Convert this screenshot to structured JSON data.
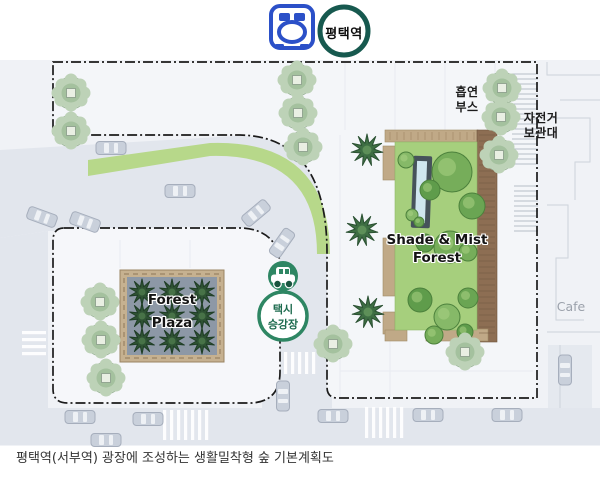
{
  "station": {
    "label": "평택역"
  },
  "taxi": {
    "line1": "택시",
    "line2": "승강장"
  },
  "labels": {
    "smoking_line1": "흡연",
    "smoking_line2": "부스",
    "bike_line1": "자전거",
    "bike_line2": "보관대",
    "cafe": "Cafe",
    "shade_mist_line1": "Shade & Mist",
    "shade_mist_line2": "Forest",
    "forest_plaza_line1": "Forest",
    "forest_plaza_line2": "Plaza"
  },
  "caption": "평택역(서부역) 광장에 조성하는 생활밀착형 숲 기본계획도",
  "colors": {
    "road": "#e2e6ed",
    "east_plaza": "#f4f6f9",
    "west_plaza": "#f6f7fa",
    "green_strip": "#b7d88a",
    "boundary": "#1b1b1b",
    "sage_outer": "#c7d8c2",
    "sage_mid": "#bdd2b7",
    "sage_inner": "#a4c19e",
    "spiky_fill": "#3e6e43",
    "spiky_edge": "#2b5133",
    "forest_ground": "#a6cf7d",
    "deck_tan": "#c0a987",
    "deck_brown": "#8d6e53",
    "plaza_floor": "#8d98a6",
    "plaza_border": "#c6b190",
    "mist_dark": "#46525b",
    "mist_water": "#cfe6ef",
    "station_ring": "#17594f",
    "train_blue": "#2b50c8",
    "taxi_green": "#2e8663",
    "car_body": "#c9d0db",
    "car_edge": "#a6aebc",
    "car_glass": "#eef1f5"
  },
  "map": {
    "trees_sage": [
      [
        71,
        93
      ],
      [
        71,
        131
      ],
      [
        297,
        80
      ],
      [
        298,
        113
      ],
      [
        303,
        147
      ],
      [
        100,
        302
      ],
      [
        101,
        340
      ],
      [
        106,
        378
      ],
      [
        502,
        88
      ],
      [
        501,
        117
      ],
      [
        499,
        155
      ],
      [
        465,
        352
      ],
      [
        333,
        344
      ]
    ],
    "trees_spiky": [
      [
        367,
        150
      ],
      [
        362,
        230
      ],
      [
        368,
        312
      ]
    ],
    "forest_trees": [
      [
        452,
        172,
        20
      ],
      [
        430,
        190,
        10
      ],
      [
        406,
        160,
        8
      ],
      [
        472,
        206,
        13
      ],
      [
        450,
        247,
        16
      ],
      [
        425,
        243,
        9
      ],
      [
        412,
        215,
        6
      ],
      [
        419,
        222,
        5
      ],
      [
        468,
        252,
        9
      ],
      [
        420,
        300,
        12
      ],
      [
        447,
        317,
        13
      ],
      [
        468,
        298,
        10
      ],
      [
        434,
        335,
        9
      ],
      [
        465,
        332,
        8
      ]
    ],
    "plaza_grid_trees": [
      [
        142,
        292
      ],
      [
        172,
        292
      ],
      [
        202,
        292
      ],
      [
        142,
        316
      ],
      [
        172,
        316
      ],
      [
        202,
        316
      ],
      [
        142,
        341
      ],
      [
        172,
        341
      ],
      [
        202,
        341
      ]
    ],
    "cars": [
      [
        111,
        148,
        0
      ],
      [
        180,
        191,
        0
      ],
      [
        42,
        217,
        20
      ],
      [
        85,
        222,
        20
      ],
      [
        256,
        213,
        -40
      ],
      [
        282,
        243,
        -55
      ],
      [
        283,
        396,
        90
      ],
      [
        80,
        417,
        0
      ],
      [
        148,
        419,
        0
      ],
      [
        106,
        440,
        0
      ],
      [
        333,
        416,
        0
      ],
      [
        428,
        415,
        0
      ],
      [
        507,
        415,
        0
      ],
      [
        565,
        370,
        90
      ]
    ],
    "crosswalks": [
      [
        284,
        352,
        34,
        22,
        "v"
      ],
      [
        163,
        410,
        44,
        30,
        "v"
      ],
      [
        365,
        407,
        38,
        31,
        "v"
      ],
      [
        22,
        331,
        24,
        28,
        "h"
      ]
    ],
    "bike_racks": [
      [
        512,
        74,
        26,
        94
      ],
      [
        514,
        186,
        24,
        46
      ]
    ]
  }
}
